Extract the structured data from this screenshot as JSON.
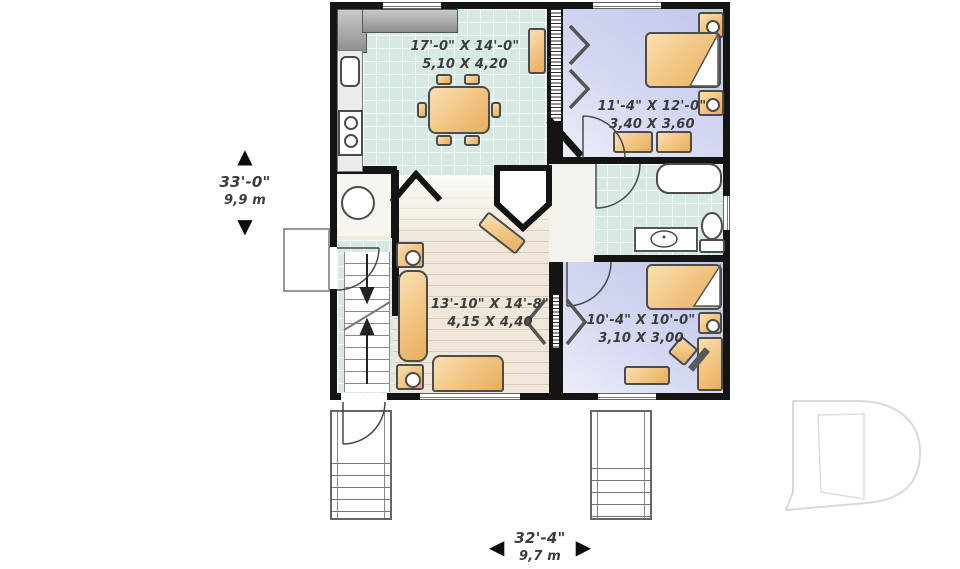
{
  "plan": {
    "rooms": [
      {
        "id": "kitchen-dining",
        "imperial": "17'-0\" X 14'-0\"",
        "metric": "5,10 X 4,20"
      },
      {
        "id": "bedroom-upper",
        "imperial": "11'-4\" X 12'-0\"",
        "metric": "3,40 X 3,60"
      },
      {
        "id": "living-room",
        "imperial": "13'-10\" X 14'-8\"",
        "metric": "4,15 X 4,40"
      },
      {
        "id": "bedroom-lower",
        "imperial": "10'-4\" X 10'-0\"",
        "metric": "3,10 X 3,00"
      }
    ],
    "overall_depth": {
      "imperial": "33'-0\"",
      "metric": "9,9 m"
    },
    "overall_width": {
      "imperial": "32'-4\"",
      "metric": "9,7 m"
    },
    "markers": {
      "up": "▲",
      "down": "▼",
      "left": "◀",
      "right": "▶"
    },
    "colors": {
      "wall": "#141414",
      "tile_floor": "#d6e9e3",
      "bedroom_floor": "#c9cdec",
      "wood_floor": "#efe8da",
      "furniture": "#f3c887",
      "logo_gray": "#d9d9d9"
    },
    "logo": "builder-d-watermark"
  }
}
